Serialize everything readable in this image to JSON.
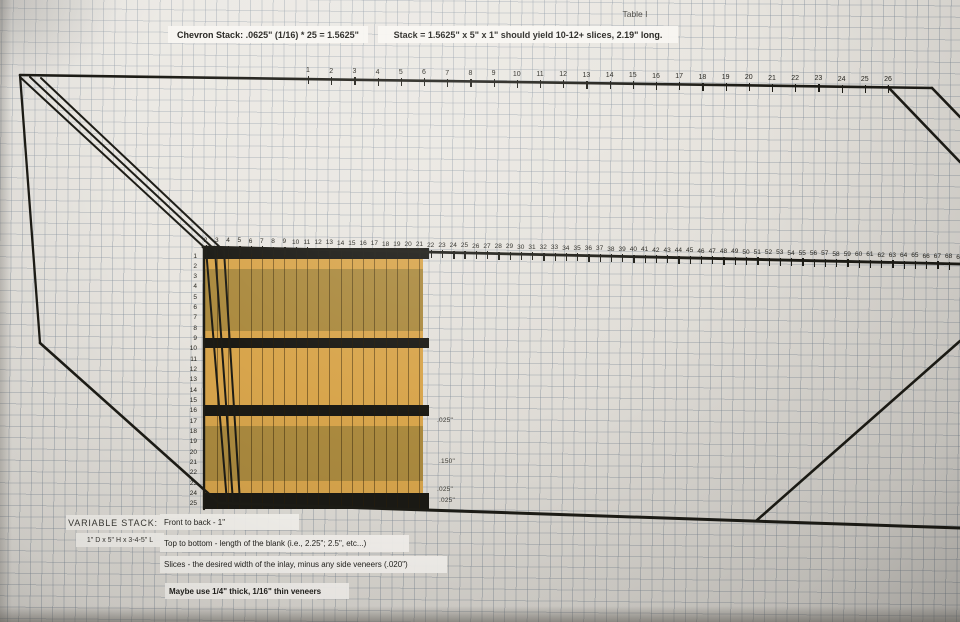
{
  "title": "Table I",
  "header": {
    "chevron": "Chevron Stack:  .0625\" (1/16) * 25 = 1.5625\"",
    "stack": "Stack = 1.5625\" x 5\" x 1\" should yield 10-12+ slices, 2.19\" long."
  },
  "scales": {
    "top": [
      1,
      2,
      3,
      4,
      5,
      6,
      7,
      8,
      9,
      10,
      11,
      12,
      13,
      14,
      15,
      16,
      17,
      18,
      19,
      20,
      21,
      22,
      23,
      24,
      25,
      26
    ],
    "middle": [
      2,
      3,
      4,
      5,
      6,
      7,
      8,
      9,
      10,
      11,
      12,
      13,
      14,
      15,
      16,
      17,
      18,
      19,
      20,
      21,
      22,
      23,
      24,
      25,
      26,
      27,
      28,
      29,
      30,
      31,
      32,
      33,
      34,
      35,
      36,
      37,
      38,
      39,
      40,
      41,
      42,
      43,
      44,
      45,
      46,
      47,
      48,
      49,
      50,
      51,
      52,
      53,
      54,
      55,
      56,
      57,
      58,
      59,
      60,
      61,
      62,
      63,
      64,
      65,
      66,
      67,
      68,
      69
    ],
    "left": [
      1,
      2,
      3,
      4,
      5,
      6,
      7,
      8,
      9,
      10,
      11,
      12,
      13,
      14,
      15,
      16,
      17,
      18,
      19,
      20,
      21,
      22,
      23,
      24,
      25
    ]
  },
  "measurements": [
    ".025\"",
    ".150\"",
    ".025\"",
    ".025\""
  ],
  "notes": {
    "heading": "VARIABLE STACK:",
    "dimensions": "1\" D x 5\" H x 3-4-5\" L",
    "lines": [
      "Front to back - 1\"",
      "Top to bottom - length of the blank (i.e., 2.25\"; 2.5\", etc...)",
      "Slices - the desired width of the inlay, minus any side veneers (.020\")"
    ],
    "note": "Maybe use 1/4\" thick, 1/16\" thin veneers"
  },
  "stack_bands": [
    {
      "material": "veneer-black",
      "h": 11
    },
    {
      "material": "veneer-tan",
      "h": 10
    },
    {
      "material": "core-olive",
      "h": 62
    },
    {
      "material": "veneer-tan",
      "h": 7
    },
    {
      "material": "veneer-black",
      "h": 10
    },
    {
      "material": "core-tan",
      "h": 57
    },
    {
      "material": "veneer-black",
      "h": 11
    },
    {
      "material": "veneer-tan",
      "h": 10
    },
    {
      "material": "core-olive",
      "h": 55
    },
    {
      "material": "veneer-tan",
      "h": 12
    },
    {
      "material": "veneer-black",
      "h": 16
    }
  ],
  "colors": {
    "tan": "#d8a54c",
    "olive": "#ab8a3f",
    "black": "#1b1a15",
    "paper": "#e8e5df"
  }
}
